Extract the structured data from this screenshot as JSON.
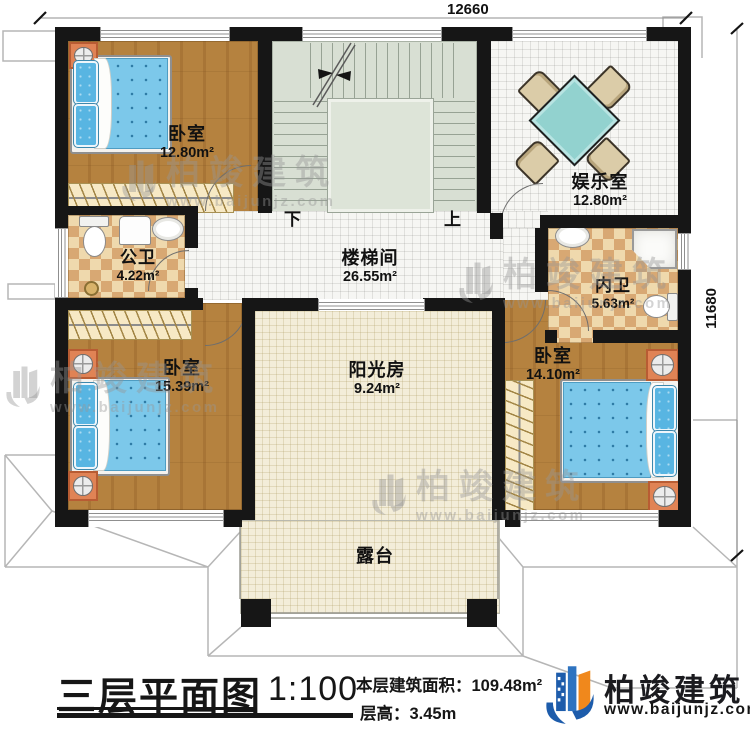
{
  "plan": {
    "dimensions": {
      "top": "12660",
      "right": "11680"
    },
    "rooms": [
      {
        "id": "bedroom1",
        "name": "卧室",
        "area": "12.80m²"
      },
      {
        "id": "entertainment",
        "name": "娱乐室",
        "area": "12.80m²"
      },
      {
        "id": "public-bath",
        "name": "公卫",
        "area": "4.22m²"
      },
      {
        "id": "stairwell",
        "name": "楼梯间",
        "area": "26.55m²"
      },
      {
        "id": "inner-bath",
        "name": "内卫",
        "area": "5.63m²"
      },
      {
        "id": "bedroom2",
        "name": "卧室",
        "area": "15.39m²"
      },
      {
        "id": "sunroom",
        "name": "阳光房",
        "area": "9.24m²"
      },
      {
        "id": "bedroom3",
        "name": "卧室",
        "area": "14.10m²"
      },
      {
        "id": "terrace",
        "name": "露台",
        "area": ""
      }
    ],
    "stairs": {
      "down": "下",
      "up": "上"
    }
  },
  "title_block": {
    "title": "三层平面图",
    "scale": "1:100",
    "area_label": "本层建筑面积：",
    "area_value": "109.48m²",
    "height_label": "层高：",
    "height_value": "3.45m"
  },
  "brand": {
    "name": "柏竣建筑",
    "url": "www.baijunjz.com"
  },
  "watermark": {
    "name": "柏竣建筑",
    "url": "www.baijunjz.com"
  },
  "colors": {
    "wall": "#161616",
    "wood": "#b5823f",
    "bed_blue": "#7cc8ea",
    "table_teal": "#92d2cf",
    "checker_tan": "#d8a873",
    "brand_blue": "#1d5cab",
    "brand_orange": "#f0881c"
  }
}
